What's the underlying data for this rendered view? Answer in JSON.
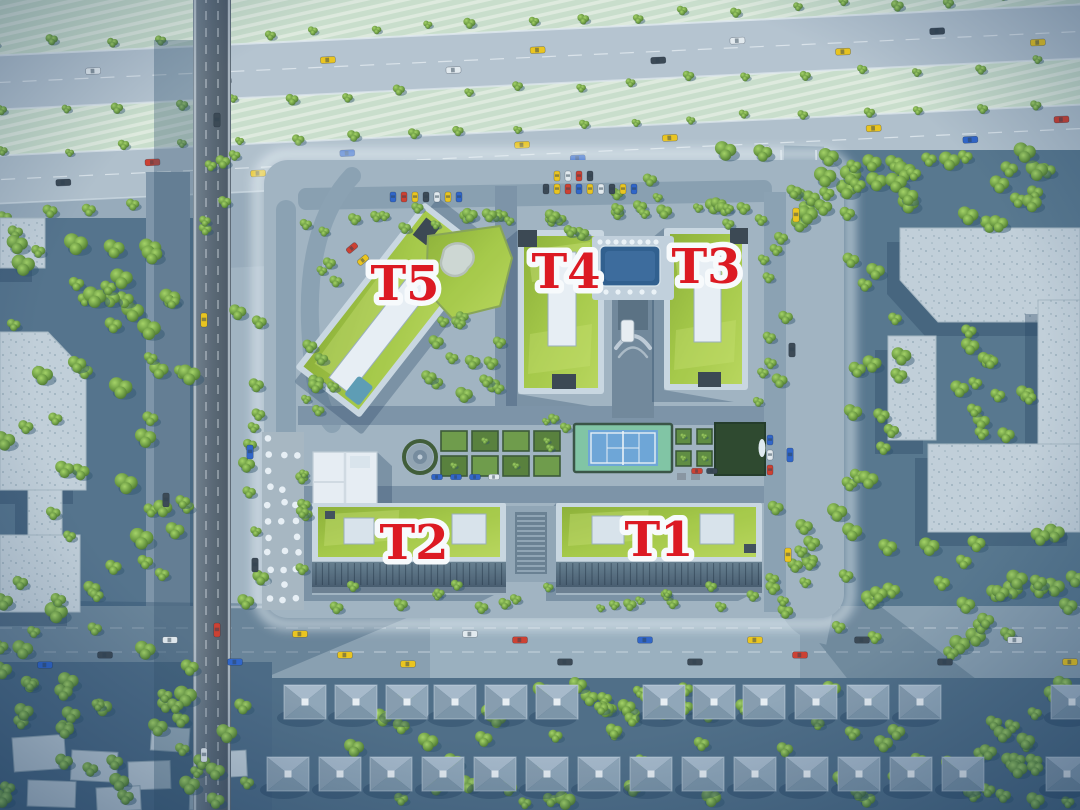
{
  "scene": {
    "description": "Aerial 3D master-plan rendering of a residential complex with five labeled apartment towers, highway, overpass bridge, amenity courtyard and villa rows",
    "building_labels": [
      {
        "id": "t5",
        "text": "T5"
      },
      {
        "id": "t4",
        "text": "T4"
      },
      {
        "id": "t3",
        "text": "T3"
      },
      {
        "id": "t2",
        "text": "T2"
      },
      {
        "id": "t1",
        "text": "T1"
      }
    ],
    "label_style": {
      "color": "#e31219",
      "outline": "#ffffff"
    },
    "features": [
      "highway-with-green-medians",
      "overpass-bridge",
      "swimming-pool",
      "kidney-pond-deck",
      "tennis-court",
      "garden-beds",
      "fountain-plaza",
      "umbrella-terrace",
      "kindergarten-block",
      "parking-rows",
      "villa-houses",
      "tree-belts",
      "neighbor-blocks"
    ],
    "palette": {
      "ground": "#a4b5c2",
      "ground_dark": "#8fa3b2",
      "road": "#b9c6d1",
      "road_mid": "#8ba0b0",
      "road_dark": "#6d8295",
      "field": "#cfe2cd",
      "field_stripe": "#e5efe0",
      "roof_green": "#9fc238",
      "roof_green_light": "#cde470",
      "wall": "#cfdae3",
      "core_white": "#eef3f7",
      "facade": "#5d7487",
      "pool": "#2d5c8c",
      "pool_light": "#3a699b",
      "pond": "#d3dad4",
      "tennis_apron": "#82c7a3",
      "tennis_court": "#6ea6d8",
      "tree_light": "#9ccb55",
      "tree_dark": "#49742a",
      "villa_top": "#aabccb",
      "villa_left": "#889dae",
      "villa_right": "#92a7b8",
      "villa_bottom": "#7d94a6",
      "overpass_light": "#6b7884",
      "overpass_dark": "#4f5b66",
      "backdrop": "#53718a",
      "shadow": "#22405d",
      "car_yellow": "#f2c716",
      "car_red": "#d23b2a",
      "car_blue": "#2d62c9",
      "car_white": "#e9eef2",
      "car_dark": "#39444f"
    }
  }
}
